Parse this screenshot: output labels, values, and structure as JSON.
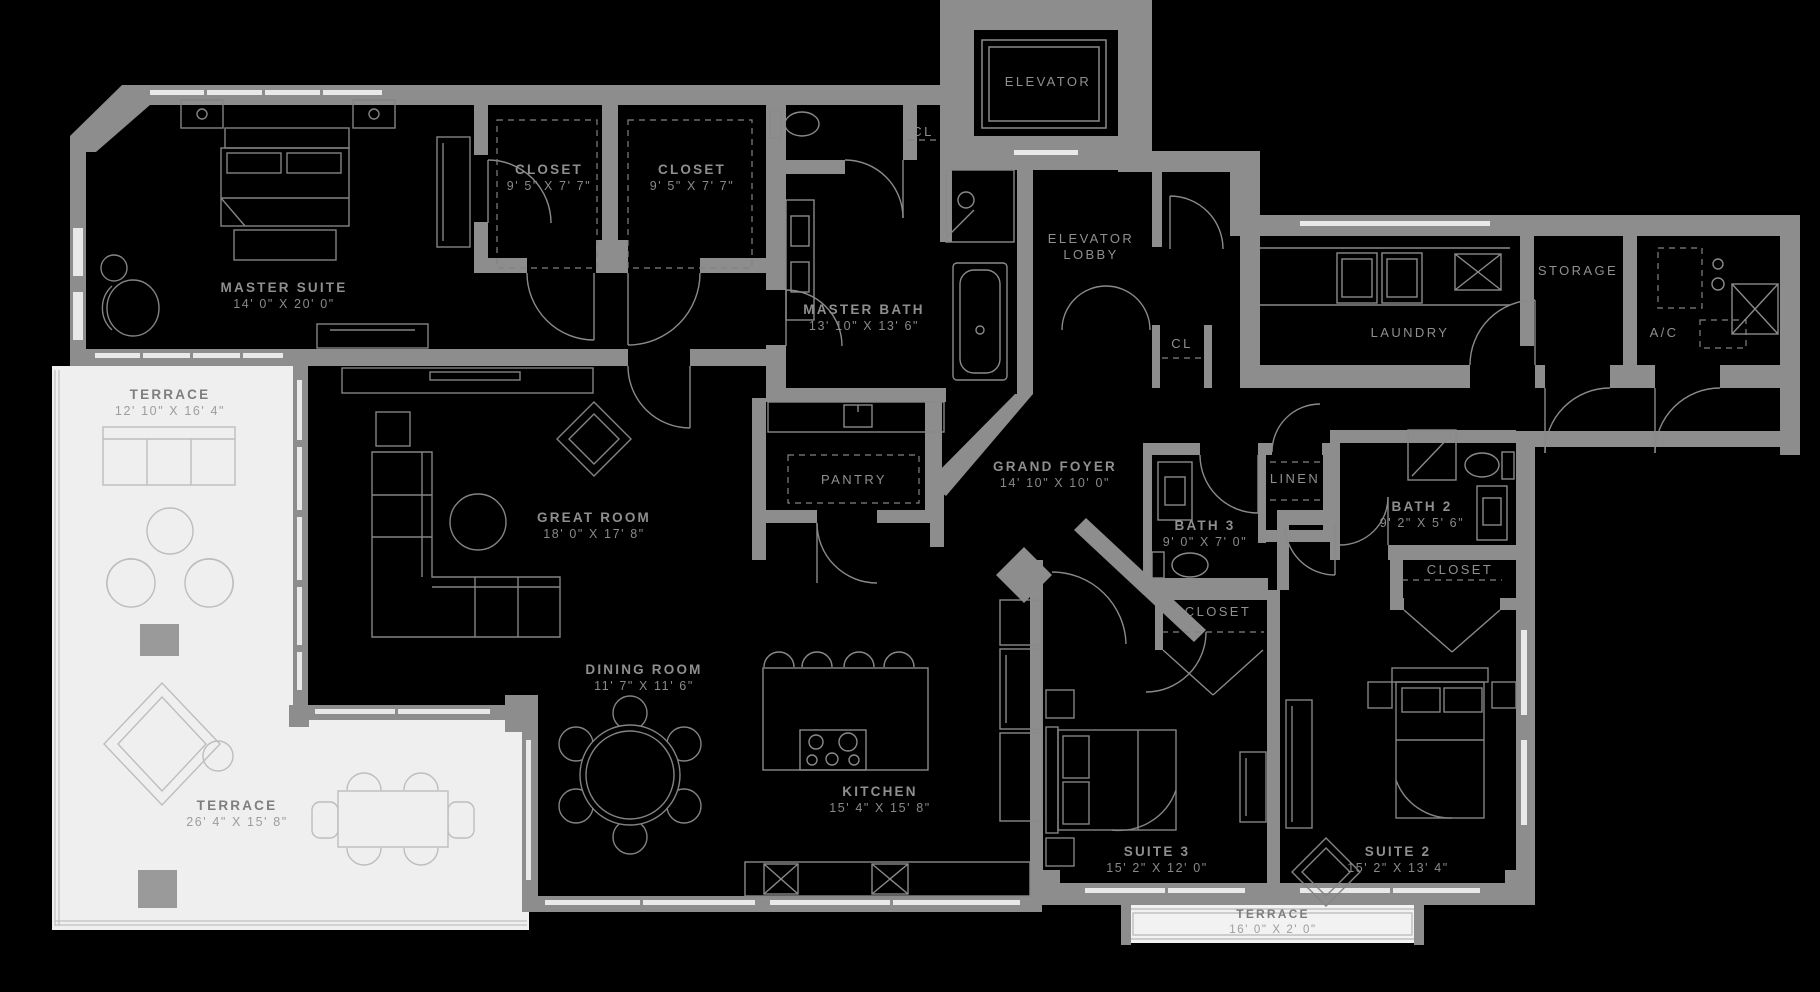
{
  "plan_type": "residential-floor-plan",
  "colors": {
    "background": "#000000",
    "walls": "#8d8d8d",
    "terrace_floor": "#efefef",
    "furniture_line_dark_bg": "#848484",
    "furniture_line_light_bg": "#bdbdbd",
    "label_text": "#8f8f8f"
  },
  "rooms": {
    "master_suite": {
      "name": "MASTER SUITE",
      "dims": "14' 0\" X 20' 0\""
    },
    "closet_a": {
      "name": "CLOSET",
      "dims": "9' 5\" X 7' 7\""
    },
    "closet_b": {
      "name": "CLOSET",
      "dims": "9' 5\" X 7' 7\""
    },
    "elevator": {
      "name": "ELEVATOR"
    },
    "cl_upper": {
      "name": "CL"
    },
    "elevator_lobby": {
      "name": "ELEVATOR",
      "name2": "LOBBY"
    },
    "master_bath": {
      "name": "MASTER BATH",
      "dims": "13' 10\" X 13' 6\""
    },
    "laundry": {
      "name": "LAUNDRY"
    },
    "storage": {
      "name": "STORAGE"
    },
    "ac": {
      "name": "A/C"
    },
    "cl_hall": {
      "name": "CL"
    },
    "terrace_upper": {
      "name": "TERRACE",
      "dims": "12' 10\" X 16' 4\""
    },
    "great_room": {
      "name": "GREAT ROOM",
      "dims": "18' 0\" X 17' 8\""
    },
    "pantry": {
      "name": "PANTRY"
    },
    "grand_foyer": {
      "name": "GRAND FOYER",
      "dims": "14' 10\" X 10' 0\""
    },
    "bath_3": {
      "name": "BATH 3",
      "dims": "9' 0\" X 7' 0\""
    },
    "linen": {
      "name": "LINEN"
    },
    "bath_2": {
      "name": "BATH 2",
      "dims": "9' 2\" X 5' 6\""
    },
    "closet_suite2": {
      "name": "CLOSET"
    },
    "closet_suite3": {
      "name": "CLOSET"
    },
    "dining_room": {
      "name": "DINING ROOM",
      "dims": "11' 7\" X 11' 6\""
    },
    "kitchen": {
      "name": "KITCHEN",
      "dims": "15' 4\" X 15' 8\""
    },
    "suite_3": {
      "name": "SUITE 3",
      "dims": "15' 2\" X 12' 0\""
    },
    "suite_2": {
      "name": "SUITE 2",
      "dims": "15' 2\" X 13' 4\""
    },
    "terrace_main": {
      "name": "TERRACE",
      "dims": "26' 4\" X 15' 8\""
    },
    "terrace_suites": {
      "name": "TERRACE",
      "dims": "16' 0\" X 2' 0\""
    }
  }
}
